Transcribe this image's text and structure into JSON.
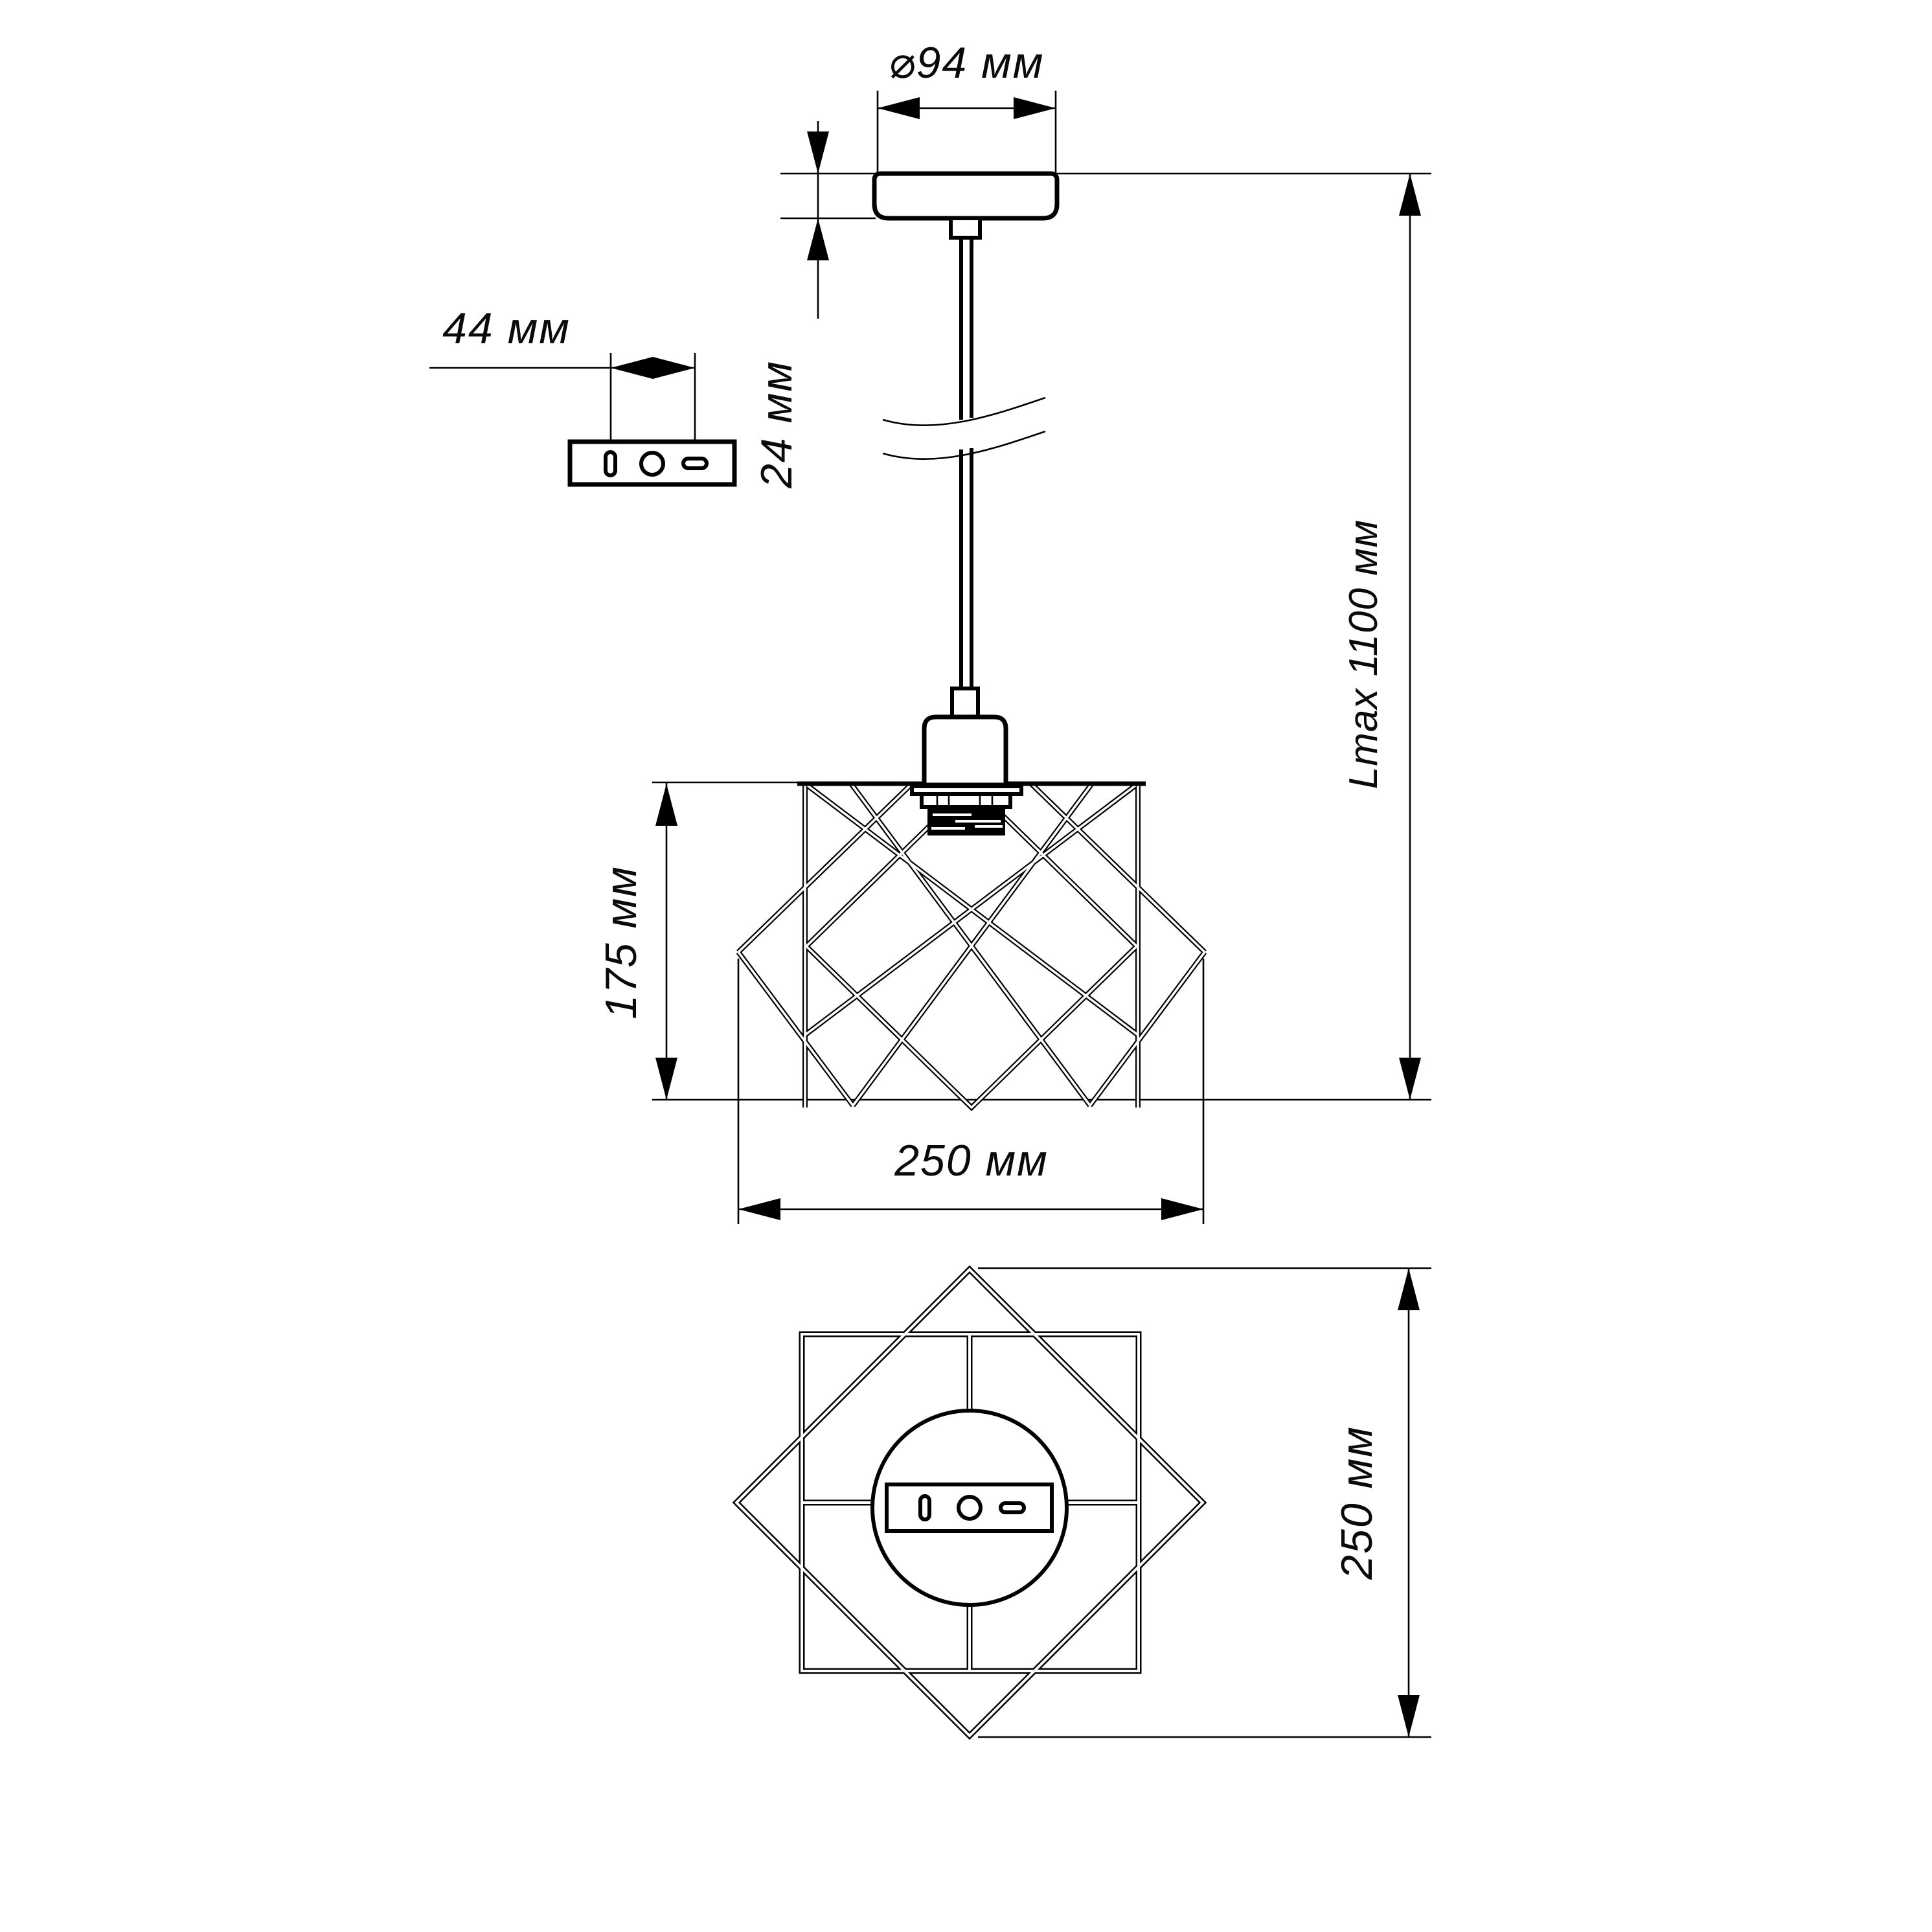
{
  "drawing": {
    "kind": "pendant-lamp-dimension-drawing",
    "background": "#ffffff",
    "line_color": "#000000"
  },
  "dimensions": {
    "canopy_diameter": "⌀94 мм",
    "canopy_height": "24 мм",
    "bracket_hole_spacing": "44 мм",
    "max_suspension_length": "Lmax 1100 мм",
    "shade_height": "175 мм",
    "shade_width": "250 мм",
    "shade_depth": "250 мм"
  }
}
